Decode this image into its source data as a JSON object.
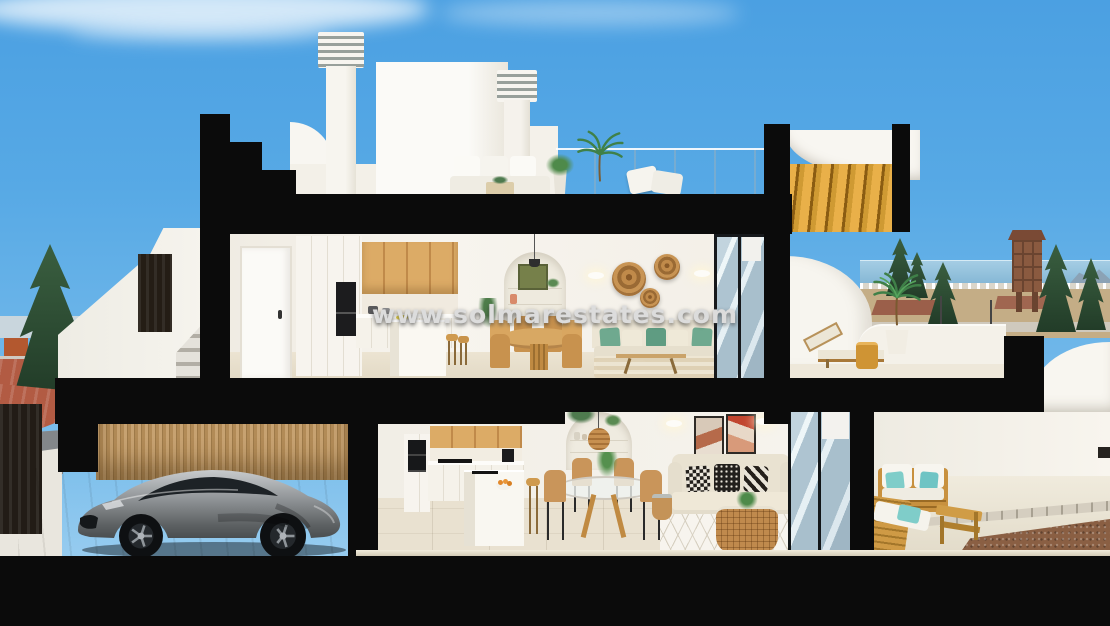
{
  "watermark": {
    "text": "www.solmarestates.com"
  },
  "scene": {
    "type": "architectural-cutaway-3d-render",
    "subject": "two-storey coastal villa cross-section",
    "floors": [
      {
        "name": "roof-terrace",
        "features": [
          "chimneys",
          "penthouse-bulkhead",
          "outdoor-sofa",
          "potted-palm",
          "glass-railing",
          "wood-pergola"
        ]
      },
      {
        "name": "upper-floor",
        "features": [
          "entry-door",
          "kitchen",
          "island-with-stools",
          "dining-table",
          "arched-niche",
          "sofa-with-green-cushions",
          "wall-baskets",
          "sliding-glass-door",
          "terrace-with-sun-lounger"
        ]
      },
      {
        "name": "ground-floor",
        "features": [
          "garage-with-sports-car",
          "bamboo-fence",
          "kitchen",
          "glass-dining-table",
          "arched-niche-with-rattan-pendant",
          "sofa-with-patterned-cushions",
          "gallery-frames",
          "rattan-coffee-table",
          "sliding-glass-door",
          "terrace-with-wooden-lounge-set"
        ]
      }
    ],
    "background": [
      "blue-sky",
      "clouds",
      "town-skyline",
      "trees",
      "sea",
      "watchtower",
      "street-with-red-pavement"
    ]
  },
  "colors": {
    "sky": "#57a9e5",
    "section_cut": "#0b0b0b",
    "walls": "#f5f2ec",
    "wood_cabinet": "#d8a863",
    "pergola_wood": "#dfa63c",
    "floor": "#e8e0cf",
    "sofa": "#e6dfcd",
    "cushion_green": "#6fa98f",
    "cushion_teal": "#7fcdc9",
    "car_body": "#8d9194",
    "pavement_red": "#b25b43",
    "sea": "#85b9d6",
    "bamboo_fence": "#b08a55",
    "tree_green": "#2f4f33"
  }
}
